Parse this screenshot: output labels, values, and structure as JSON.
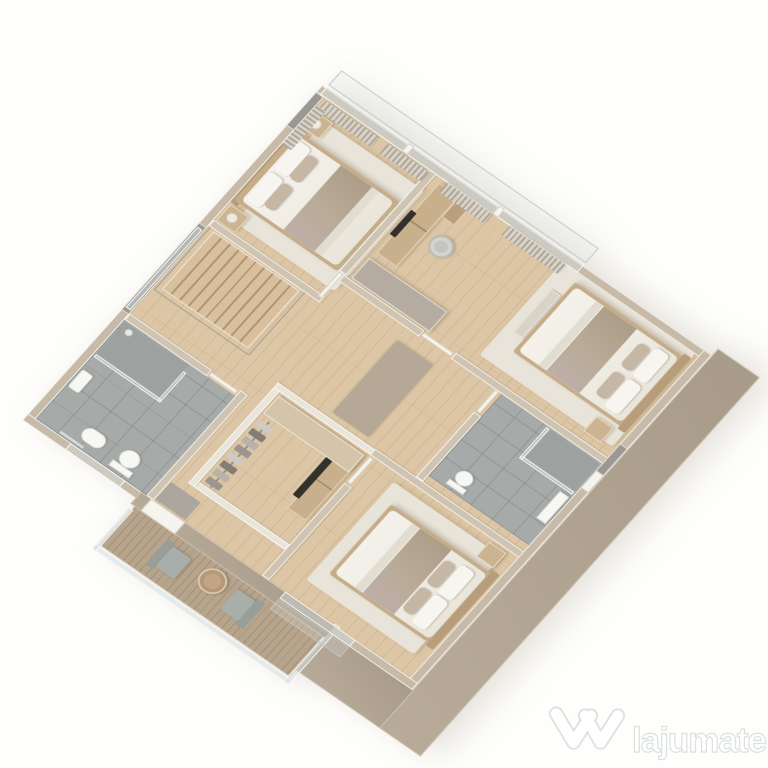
{
  "watermark": {
    "brand": "lajumate",
    "tld": ".ro",
    "logo": "w-chevron-logo"
  },
  "scene": {
    "type": "isometric-3d-floor-plan-render",
    "rooms": [
      {
        "name": "master-bedroom",
        "contents": [
          "double-bed",
          "nightstand-left",
          "nightstand-right",
          "table-lamp",
          "table-lamp",
          "area-rug",
          "window-curtains"
        ]
      },
      {
        "name": "bedroom-right",
        "contents": [
          "double-bed",
          "desk",
          "monitor",
          "office-chair",
          "tall-wardrobe",
          "bench",
          "nightstand",
          "area-rug",
          "window-curtains"
        ]
      },
      {
        "name": "bedroom-bottom",
        "contents": [
          "double-bed",
          "nightstand",
          "area-rug",
          "tv-console",
          "tv"
        ]
      },
      {
        "name": "main-bathroom",
        "contents": [
          "toilet",
          "bidet",
          "wall-sink",
          "walk-in-shower",
          "glass-partition",
          "towel-rail"
        ]
      },
      {
        "name": "ensuite-bathroom",
        "contents": [
          "toilet",
          "walk-in-shower",
          "glass-partition",
          "vanity"
        ]
      },
      {
        "name": "walk-in-closet",
        "contents": [
          "clothes-rail",
          "hanging-clothes",
          "sideboard"
        ]
      },
      {
        "name": "hallway",
        "contents": [
          "staircase",
          "stair-railing",
          "runner-rug"
        ]
      },
      {
        "name": "terrace",
        "contents": [
          "deck-planks",
          "glass-railing",
          "armchair",
          "armchair",
          "round-coffee-table",
          "door-mat"
        ]
      }
    ],
    "palette": {
      "background": "#fefefc",
      "wood_floor": "#dcc6a5",
      "wall_cap": "#cfc3b1",
      "wall_face": "#f2efe8",
      "exterior_facade": "#b3a695",
      "bathroom_tile": "#a6aaa8",
      "deck": "#b7a48c",
      "bedding": "#efece4",
      "throw_blanket": "#b9ab97",
      "rug": "#e9e4d9",
      "glass": "#d0dbdc",
      "curtain": "#b2aca1"
    }
  }
}
